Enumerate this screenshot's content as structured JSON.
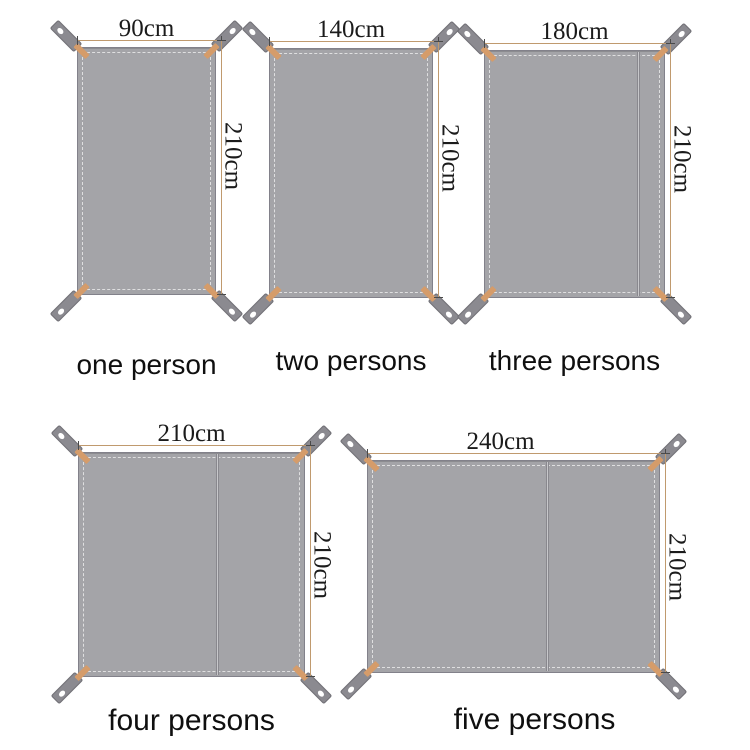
{
  "figures": [
    {
      "caption": "one person",
      "width_label": "90cm",
      "height_label": "210cm"
    },
    {
      "caption": "two persons",
      "width_label": "140cm",
      "height_label": "210cm"
    },
    {
      "caption": "three persons",
      "width_label": "180cm",
      "height_label": "210cm"
    },
    {
      "caption": "four persons",
      "width_label": "210cm",
      "height_label": "210cm"
    },
    {
      "caption": "five persons",
      "width_label": "240cm",
      "height_label": "210cm"
    }
  ],
  "colors": {
    "sheet": "#a4a4a8",
    "sheet_border": "#82818a",
    "stitch": "rgba(255,255,255,0.65)",
    "strap": "#8b8a90",
    "strap_border": "#706f75",
    "grommet": "#ffffff",
    "corner_patch": "#d59c6a",
    "dimension_line": "#c09a6e",
    "tick": "#4a4a4a",
    "dimension_text": "#1b1b1b",
    "caption_text": "#0f0f0f"
  }
}
